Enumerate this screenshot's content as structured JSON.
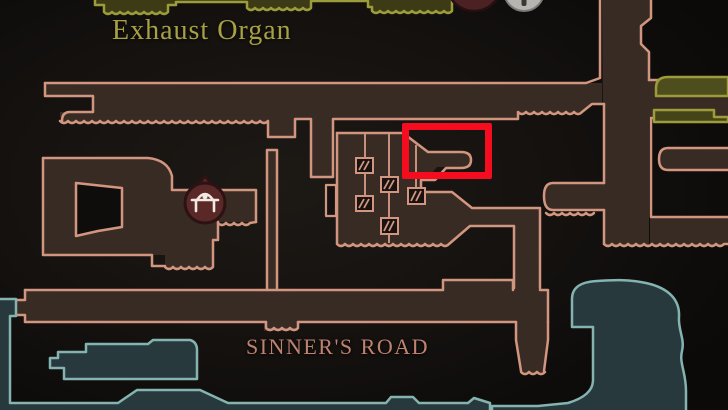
{
  "map": {
    "area_labels": [
      {
        "id": "exhaust-organ",
        "label": "Exhaust Organ",
        "color": "#a7a143"
      },
      {
        "id": "sinners-road",
        "label": "SINNER'S ROAD",
        "color": "#c08270"
      }
    ],
    "marker": {
      "type": "highlight-rectangle",
      "color": "#f50d1f"
    },
    "icons": [
      {
        "name": "save-bench-icon",
        "desc": "dark red round badge with white bench glyph"
      },
      {
        "name": "red-circle-icon-partial",
        "desc": "dark red circle clipped at top edge"
      },
      {
        "name": "silver-circle-icon-partial",
        "desc": "silver circle clipped at top edge"
      },
      {
        "name": "elevator-icon",
        "count": 5,
        "desc": "hatched square on vertical shaft line"
      }
    ],
    "colors": {
      "background": "#14110f",
      "room_fill": "#382b23",
      "room_outline": "#d29680",
      "teal_fill": "#27393c",
      "teal_outline": "#84b3b0",
      "olive_fill": "#4e4d1e",
      "olive_outline": "#9c9c3a",
      "marker_red": "#f50d1f"
    }
  }
}
